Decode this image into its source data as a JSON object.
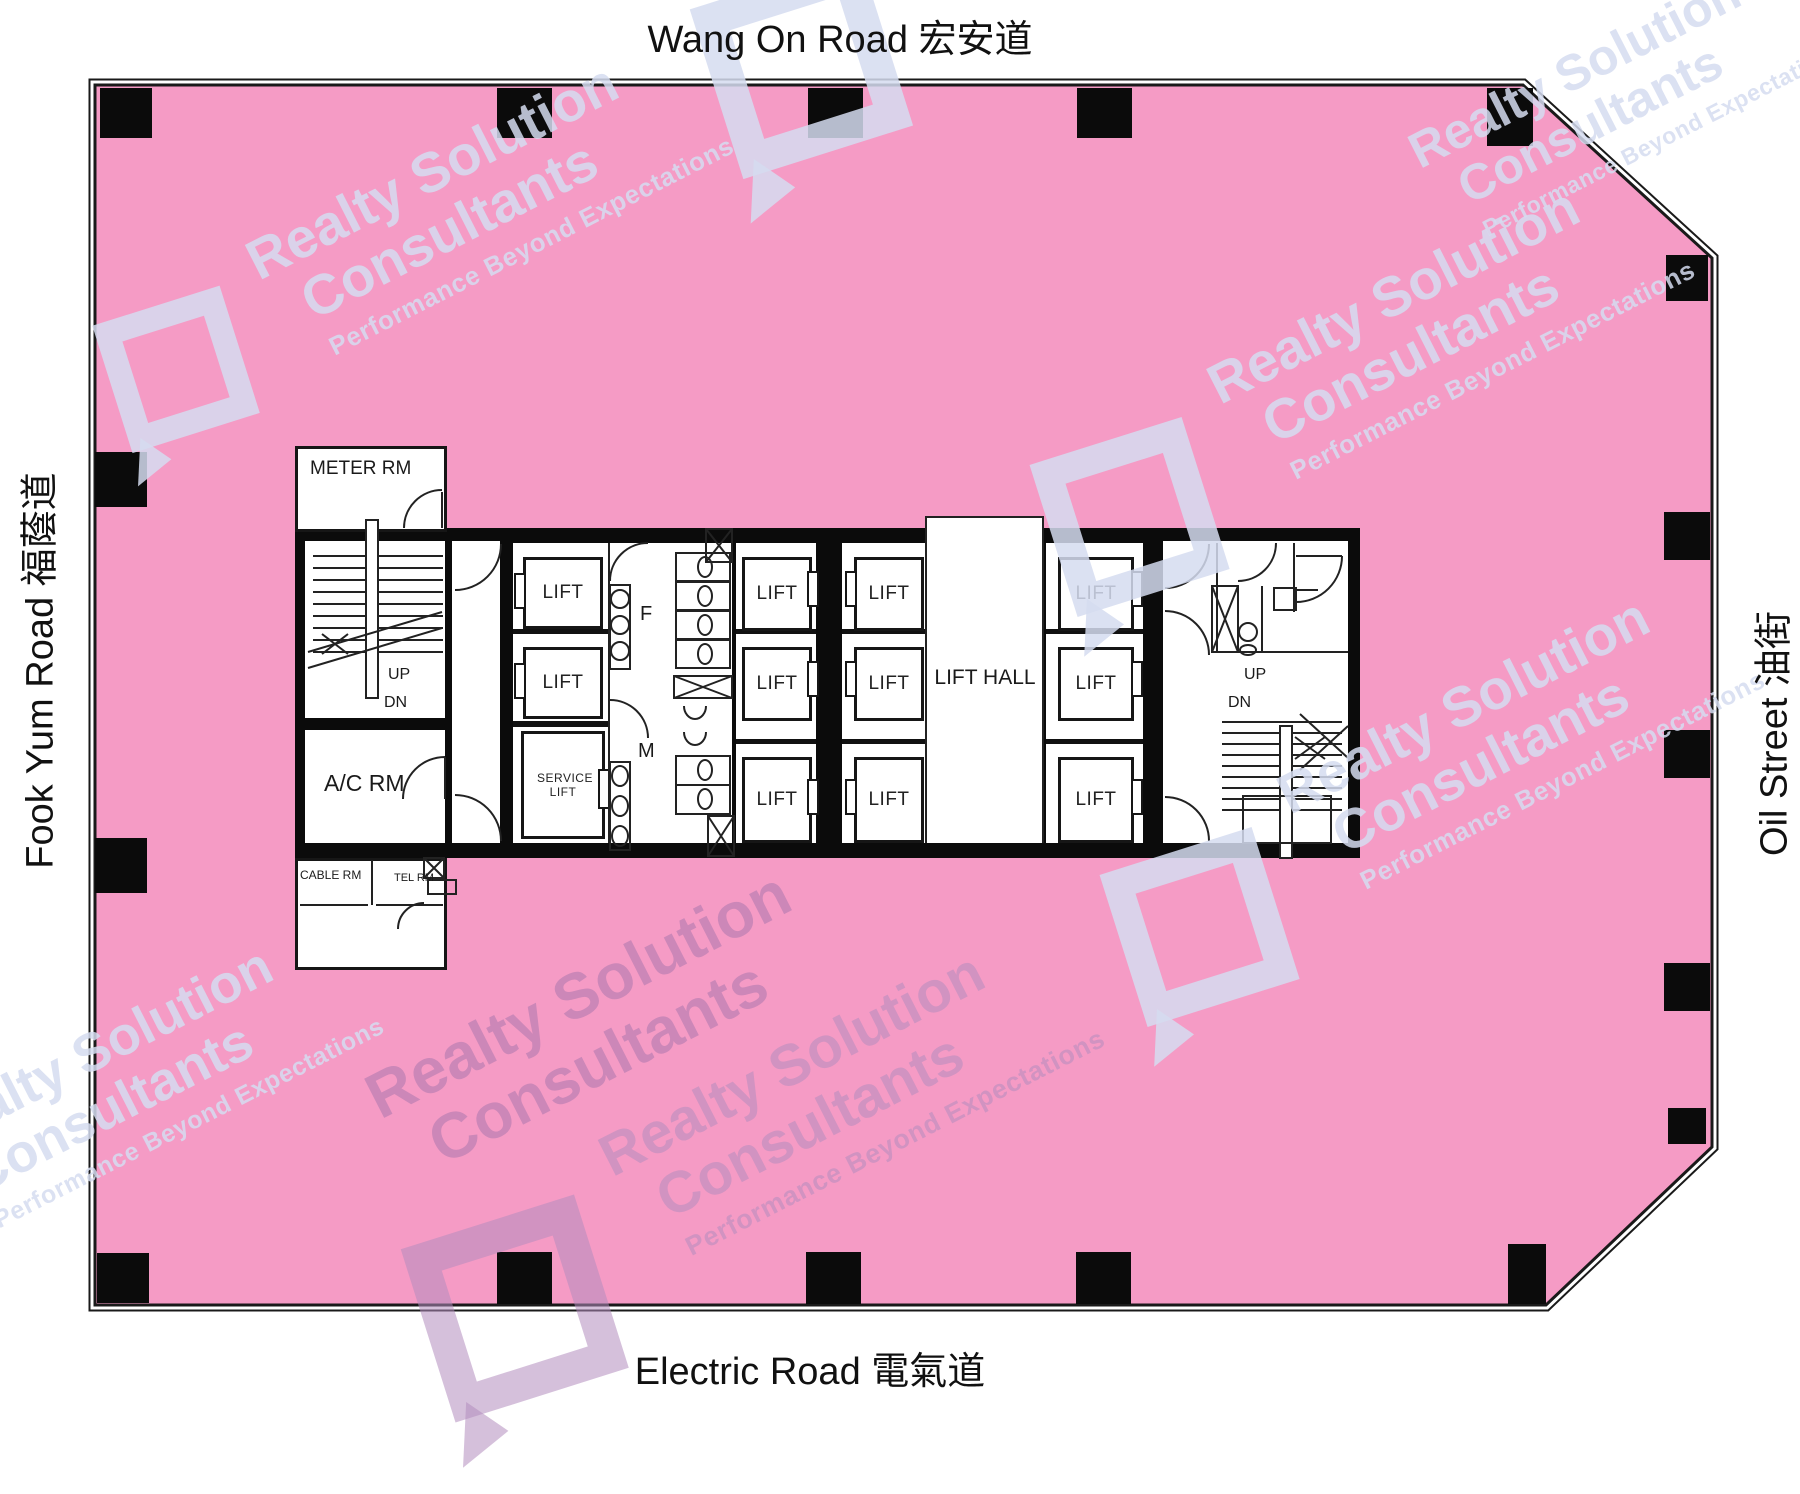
{
  "roads": {
    "top": "Wang On Road  宏安道",
    "bottom": "Electric Road  電氣道",
    "left": "Fook Yum Road  福蔭道",
    "right": "Oil Street  油街"
  },
  "core": {
    "meter_room": "METER RM",
    "ac_room": "A/C RM",
    "cable_room": "CABLE RM",
    "tel_room": "TEL RM",
    "lift": "LIFT",
    "service_lift": "SERVICE LIFT",
    "lift_hall": "LIFT HALL",
    "female": "F",
    "male": "M",
    "up": "UP",
    "down": "DN"
  },
  "watermark": {
    "line1": "Realty Solution",
    "line2": "Consultants",
    "tagline": "Performance Beyond Expectations"
  },
  "colors": {
    "floor_pink": "#F59BC5",
    "wall_black": "#0B0B0B",
    "room_white": "#FFFFFF",
    "outline": "#1A1A1A",
    "watermark_light": "rgba(213,220,240,0.85)",
    "watermark_dark": "rgba(164,116,172,0.50)"
  }
}
